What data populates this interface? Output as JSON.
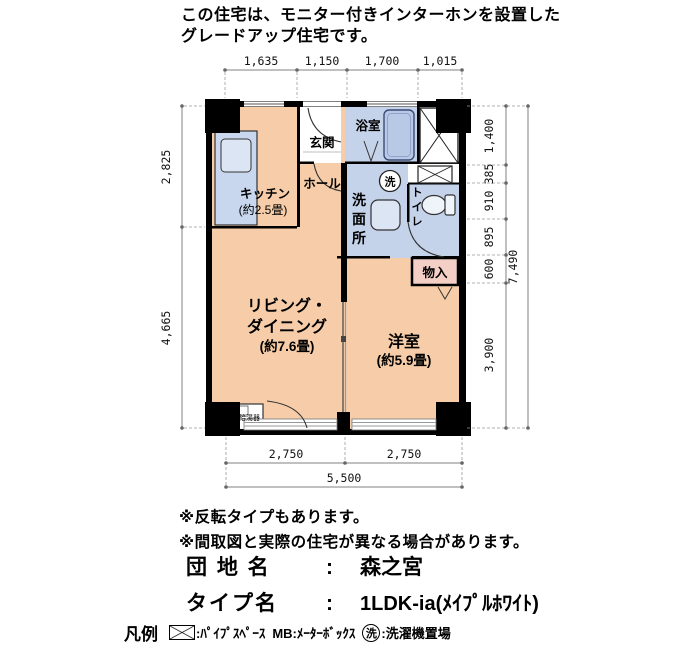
{
  "header": {
    "line1": "この住宅は、モニター付きインターホンを設置した",
    "line2": "グレードアップ住宅です。"
  },
  "plan": {
    "rooms": {
      "kitchen_name": "キッチン",
      "kitchen_size": "(約2.5畳)",
      "entrance": "玄関",
      "hall": "ホール",
      "bath": "浴室",
      "washroom": "洗面所",
      "toilet": "トイレ",
      "laundry_symbol": "洗",
      "storage": "物入",
      "living_line1": "リビング・",
      "living_line2": "ダイニング",
      "living_size": "(約7.6畳)",
      "bedroom_name": "洋室",
      "bedroom_size": "(約5.9畳)",
      "water_heater": "給湯器"
    },
    "dimensions": {
      "top": [
        "1,635",
        "1,150",
        "1,700",
        "1,015"
      ],
      "left": [
        "2,825",
        "4,665"
      ],
      "right": [
        "1,400",
        "385",
        "910",
        "895",
        "600",
        "3,900"
      ],
      "right_total": "7,490",
      "bottom": [
        "2,750",
        "2,750"
      ],
      "bottom_total": "5,500"
    }
  },
  "notes": {
    "line1": "※反転タイプもあります。",
    "line2": "※間取図と実際の住宅が異なる場合があります。"
  },
  "estate_name": {
    "label": "団 地 名",
    "colon": ":",
    "value": "森之宮"
  },
  "type_name": {
    "label": "タイプ名",
    "colon": ":",
    "value": "1LDK-ia(ﾒｲﾌﾟﾙﾎﾜｲﾄ)"
  },
  "legend": {
    "title": "凡例",
    "pipe_label": ":ﾊﾟｲﾌﾟｽﾍﾟｰｽ",
    "mb_label": "MB:ﾒｰﾀｰﾎﾞｯｸｽ",
    "wash_symbol": "洗",
    "wash_label": ":洗濯機置場"
  },
  "colors": {
    "room_peach": "#F6CDA8",
    "wet_blue": "#C5D3EA",
    "storage_pink": "#F3CFC5",
    "wall_black": "#000000"
  }
}
